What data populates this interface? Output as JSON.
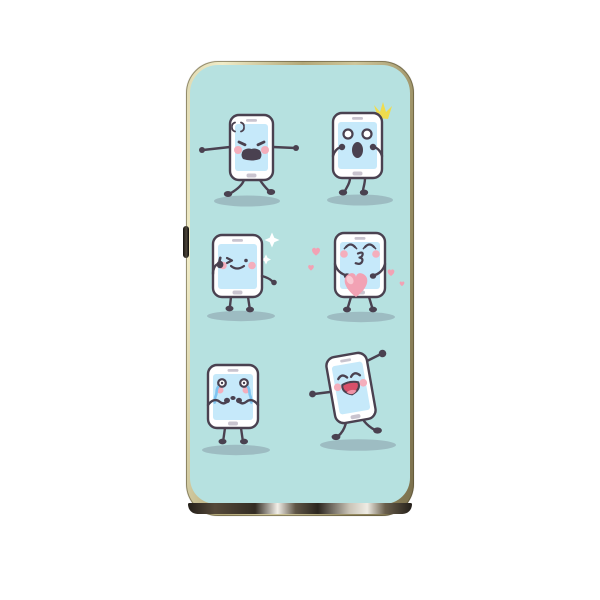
{
  "scene": {
    "description": "phone case product image with six cartoon smartphone characters",
    "background_color": "#ffffff"
  },
  "case": {
    "shape": "rounded rectangle phone case",
    "frame_finish": "gold metallic",
    "inner_background": "#b6e1e0",
    "bottom_band": "dark metallic with glints",
    "side_button": "volume button",
    "corner_highlight": "white reflection dot top right"
  },
  "characters": [
    {
      "name": "angry-phone",
      "emotion": "angry",
      "accessory": "anger mark, shouting mouth, stomping legs"
    },
    {
      "name": "surprised-phone",
      "emotion": "surprised",
      "accessory": "yellow flash, round eyes, open mouth"
    },
    {
      "name": "winking-phone",
      "emotion": "winking thumbs-up",
      "accessory": "white sparkles"
    },
    {
      "name": "kissing-phone",
      "emotion": "blowing kiss",
      "accessory": "big pink heart and floating hearts"
    },
    {
      "name": "crying-phone",
      "emotion": "crying",
      "accessory": "blue tears, fists at mouth"
    },
    {
      "name": "dancing-phone",
      "emotion": "laughing dance",
      "accessory": "tilted body, open laughing mouth"
    }
  ],
  "colors": {
    "case-teal": "#b6e1e0",
    "outline": "#4a4150",
    "phone-body": "#ffffff",
    "screen": "#c6e9fa",
    "ui-gray": "#c9c4cf",
    "cheek": "#f4aebc",
    "shadow": "#7d8a99",
    "tear": "#7fc4f0",
    "heart": "#f2a2b4",
    "heart-light": "#f8c9d3",
    "mouth-red": "#d8506a",
    "tongue": "#ef92a6",
    "sparkle-yellow": "#efdc4d"
  }
}
